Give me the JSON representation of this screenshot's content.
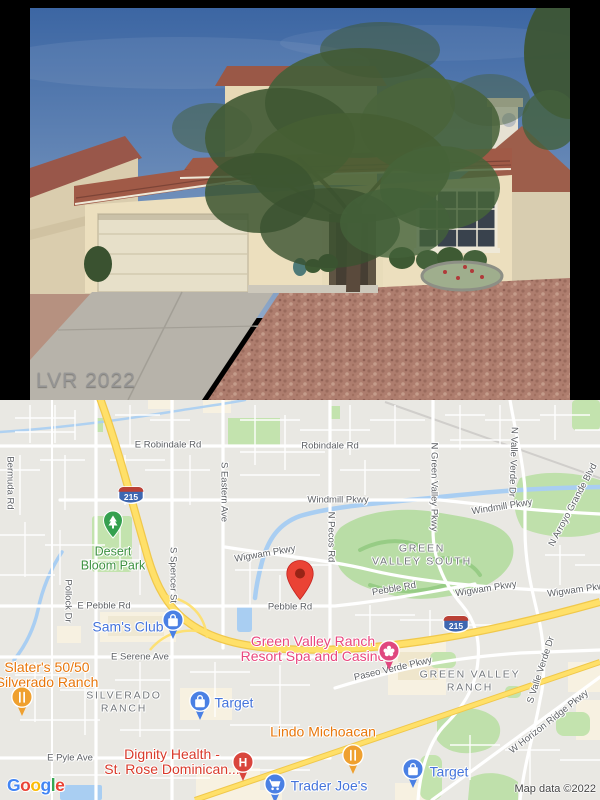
{
  "photo": {
    "watermark": "LVR 2022"
  },
  "map": {
    "shields": {
      "i215": "215"
    },
    "icons": {
      "hospital_glyph": "H"
    },
    "roads": {
      "bermuda": "Bermuda Rd",
      "e_robindale": "E Robindale Rd",
      "robindale": "Robindale Rd",
      "windmill_w": "Windmill Pkwy",
      "windmill_e": "Windmill Pkwy",
      "s_eastern": "S Eastern Ave",
      "s_spencer": "S Spencer St",
      "n_pecos": "N Pecos Rd",
      "n_green_valley": "N Green Valley Pkwy",
      "n_valle_verde": "N Valle Verde Dr",
      "n_arroyo_grande": "N Arroyo Grande Blvd",
      "wigwam_w": "Wigwam Pkwy",
      "wigwam_mid": "Wigwam Pkwy",
      "wigwam_e": "Wigwam Pkwy",
      "pebble_diag": "Pebble Rd",
      "pebble_pin": "Pebble Rd",
      "e_pebble": "E Pebble Rd",
      "pollock": "Pollock Dr",
      "e_serene": "E Serene Ave",
      "paseo_verde": "Paseo Verde Pkwy",
      "s_valle_verde": "S Valle Verde Dr",
      "w_horizon_ridge": "W Horizon Ridge Pkwy",
      "e_pyle": "E Pyle Ave"
    },
    "districts": {
      "green_valley_south": "GREEN\nVALLEY SOUTH",
      "silverado_ranch": "SILVERADO\nRANCH",
      "green_valley_ranch": "GREEN VALLEY\nRANCH"
    },
    "pois": {
      "desert_bloom_park": "Desert\nBloom Park",
      "sams_club": "Sam's Club",
      "slaters": "Slater's 50/50\nSilverado Ranch",
      "gvr_casino": "Green Valley Ranch\nResort Spa and Casino",
      "lindo_michoacan": "Lindo Michoacan",
      "dignity_health": "Dignity Health -\nSt. Rose Dominican...",
      "target_west": "Target",
      "target_east": "Target",
      "trader_joes": "Trader Joe's"
    },
    "attribution": {
      "logo_letters": [
        "G",
        "o",
        "o",
        "g",
        "l",
        "e"
      ],
      "copyright": "Map data ©2022"
    },
    "colors": {
      "poi_blue": "#4574db",
      "poi_orange": "#e8770c",
      "poi_pink": "#e9477e",
      "poi_red": "#d93a2b",
      "park_label_green": "#3d9140",
      "marker_red": "#EA4335",
      "highway_yellow": "#ffe069",
      "water_blue": "#a9cef2",
      "park_green": "#c3e3ae"
    }
  }
}
